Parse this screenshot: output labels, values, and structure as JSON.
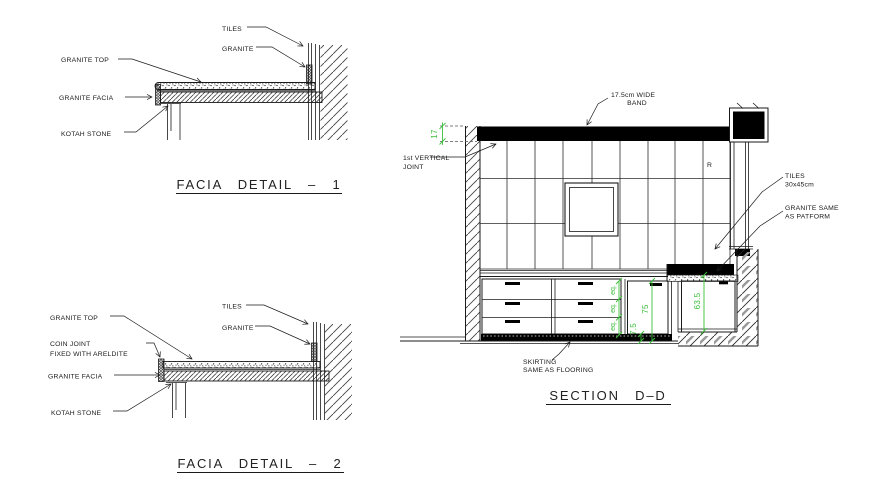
{
  "drawing_type": "interior elevation and facia details",
  "colors": {
    "background": "#ffffff",
    "line": "#1a1a1a",
    "dimension_green": "#3bbf3b",
    "band_fill": "#000000"
  },
  "facia_detail_1": {
    "title": "FACIA DETAIL – 1",
    "labels": {
      "tiles": "TILES",
      "granite": "GRANITE",
      "granite_top": "GRANITE TOP",
      "granite_facia": "GRANITE FACIA",
      "kotah_stone": "KOTAH STONE"
    }
  },
  "facia_detail_2": {
    "title": "FACIA DETAIL – 2",
    "labels": {
      "granite_top": "GRANITE TOP",
      "coin_joint_1": "COIN JOINT",
      "coin_joint_2": "FIXED WITH ARELDITE",
      "granite_facia": "GRANITE FACIA",
      "kotah_stone": "KOTAH STONE",
      "tiles": "TILES",
      "granite": "GRANITE"
    }
  },
  "section_dd": {
    "title": "SECTION D–D",
    "labels": {
      "wide_band_1": "17.5cm WIDE",
      "wide_band_2": "BAND",
      "vertical_joint_1": "1st VERTICAL",
      "vertical_joint_2": "JOINT",
      "tile_letter": "R",
      "tiles_1": "TILES",
      "tiles_2": "30x45cm",
      "granite_platform_1": "GRANITE SAME",
      "granite_platform_2": "AS PATFORM",
      "skirting_1": "SKIRTING",
      "skirting_2": "SAME AS FLOORING"
    },
    "dimensions": {
      "band_height": "17",
      "eq_1": "eq.",
      "eq_2": "eq.",
      "eq_3": "eq.",
      "unit_height": "75",
      "skirting_height": "7.5",
      "platform_height": "63.5"
    }
  }
}
